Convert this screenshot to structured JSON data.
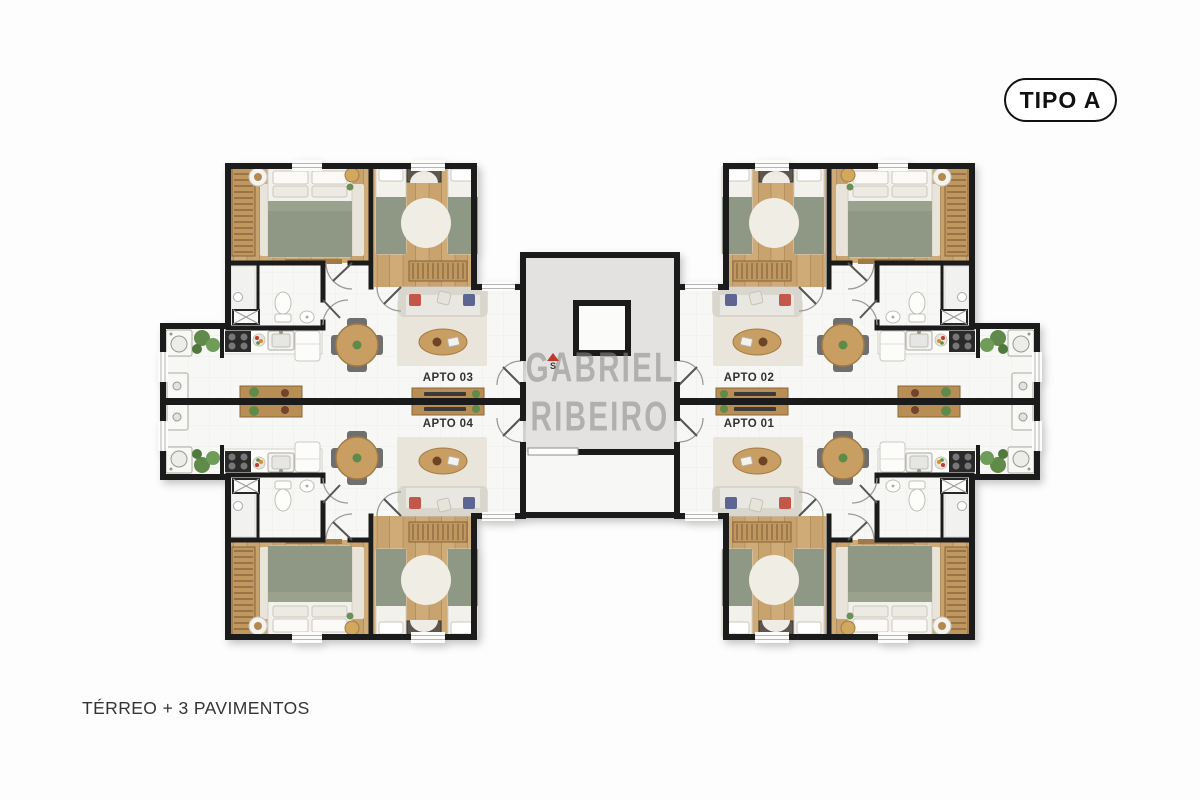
{
  "page": {
    "background": "#fdfdfd"
  },
  "badge": {
    "label": "TIPO A"
  },
  "watermark": {
    "line1": "GABRIEL",
    "line2": "RIBEIRO"
  },
  "compass": {
    "label": "S"
  },
  "floor_plan": {
    "apartments": [
      {
        "id": "apto-01",
        "label": "APTO 01",
        "position": "bottom-right"
      },
      {
        "id": "apto-02",
        "label": "APTO 02",
        "position": "top-right"
      },
      {
        "id": "apto-03",
        "label": "APTO 03",
        "position": "top-left"
      },
      {
        "id": "apto-04",
        "label": "APTO 04",
        "position": "bottom-left"
      }
    ],
    "colors": {
      "wall": "#1b1b1b",
      "wood_floor": "#c8a36e",
      "tile_floor": "#f7f7f5",
      "bedding_green": "#8f9884",
      "core_floor": "#e3e2e0",
      "furniture_wood": "#b98e55",
      "plant_green": "#5f8a49",
      "cushion_red": "#c2574a",
      "cushion_blue": "#5f6592",
      "compass_red": "#c0392b",
      "watermark_gray": "#8d8d8d"
    }
  },
  "footer": {
    "label": "TÉRREO + 3 PAVIMENTOS"
  }
}
